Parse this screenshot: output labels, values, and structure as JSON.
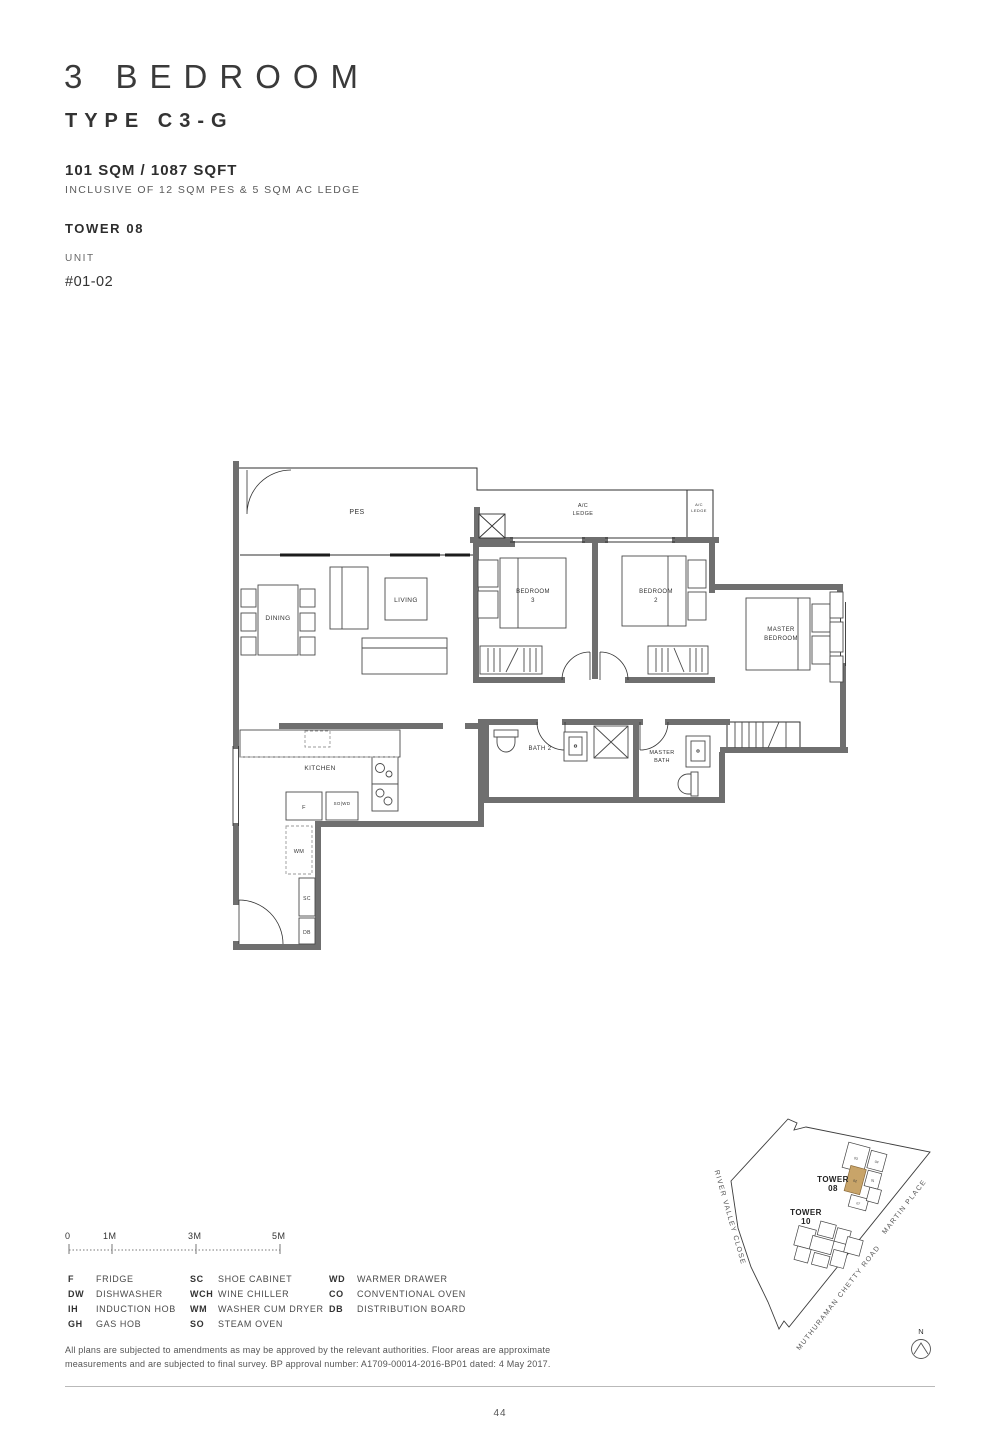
{
  "header": {
    "title": "3 BEDROOM",
    "type": "TYPE C3-G",
    "area": "101 SQM / 1087 SQFT",
    "area_note": "INCLUSIVE OF 12 SQM PES & 5 SQM AC LEDGE",
    "tower": "TOWER 08",
    "unit_label": "UNIT",
    "unit_number": "#01-02"
  },
  "floorplan": {
    "labels": {
      "pes": "PES",
      "ac_ledge_l1": "A/C",
      "ac_ledge_l2": "LEDGE",
      "ac_ledge_small_l1": "A/C",
      "ac_ledge_small_l2": "LEDGE",
      "dining": "DINING",
      "living": "LIVING",
      "bedroom3_l1": "BEDROOM",
      "bedroom3_l2": "3",
      "bedroom2_l1": "BEDROOM",
      "bedroom2_l2": "2",
      "master_bedroom_l1": "MASTER",
      "master_bedroom_l2": "BEDROOM",
      "kitchen": "KITCHEN",
      "bath2": "BATH 2",
      "master_bath_l1": "MASTER",
      "master_bath_l2": "BATH",
      "fridge": "F",
      "so_wd": "SO|WD",
      "wm": "WM",
      "sc": "SC",
      "db": "DB"
    },
    "wall_color": "#6f6f6f"
  },
  "scalebar": {
    "t0": "0",
    "t1": "1M",
    "t3": "3M",
    "t5": "5M"
  },
  "legend": {
    "col1": [
      {
        "abbr": "F",
        "name": "FRIDGE"
      },
      {
        "abbr": "DW",
        "name": "DISHWASHER"
      },
      {
        "abbr": "IH",
        "name": "INDUCTION HOB"
      },
      {
        "abbr": "GH",
        "name": "GAS HOB"
      }
    ],
    "col2": [
      {
        "abbr": "SC",
        "name": "SHOE CABINET"
      },
      {
        "abbr": "WCH",
        "name": "WINE CHILLER"
      },
      {
        "abbr": "WM",
        "name": "WASHER CUM DRYER"
      },
      {
        "abbr": "SO",
        "name": "STEAM OVEN"
      }
    ],
    "col3": [
      {
        "abbr": "WD",
        "name": "WARMER DRAWER"
      },
      {
        "abbr": "CO",
        "name": "CONVENTIONAL OVEN"
      },
      {
        "abbr": "DB",
        "name": "DISTRIBUTION BOARD"
      }
    ]
  },
  "disclaimer": {
    "line1": "All plans are subjected to amendments as may be approved by the relevant authorities. Floor areas are approximate",
    "line2": "measurements and are subjected to final survey. BP approval number: A1709-00014-2016-BP01 dated: 4 May 2017."
  },
  "sitemap": {
    "tower08_l1": "TOWER",
    "tower08_l2": "08",
    "tower10_l1": "TOWER",
    "tower10_l2": "10",
    "street_left": "RIVER VALLEY CLOSE",
    "street_bottom": "MUTHURAMAN CHETTY ROAD",
    "street_right": "MARTIN PLACE",
    "north": "N",
    "highlight_color": "#c8a469",
    "tower08_units": [
      "03",
      "04",
      "01",
      "02",
      "07"
    ],
    "highlighted_unit": "02"
  },
  "footer": {
    "page_number": "44"
  }
}
